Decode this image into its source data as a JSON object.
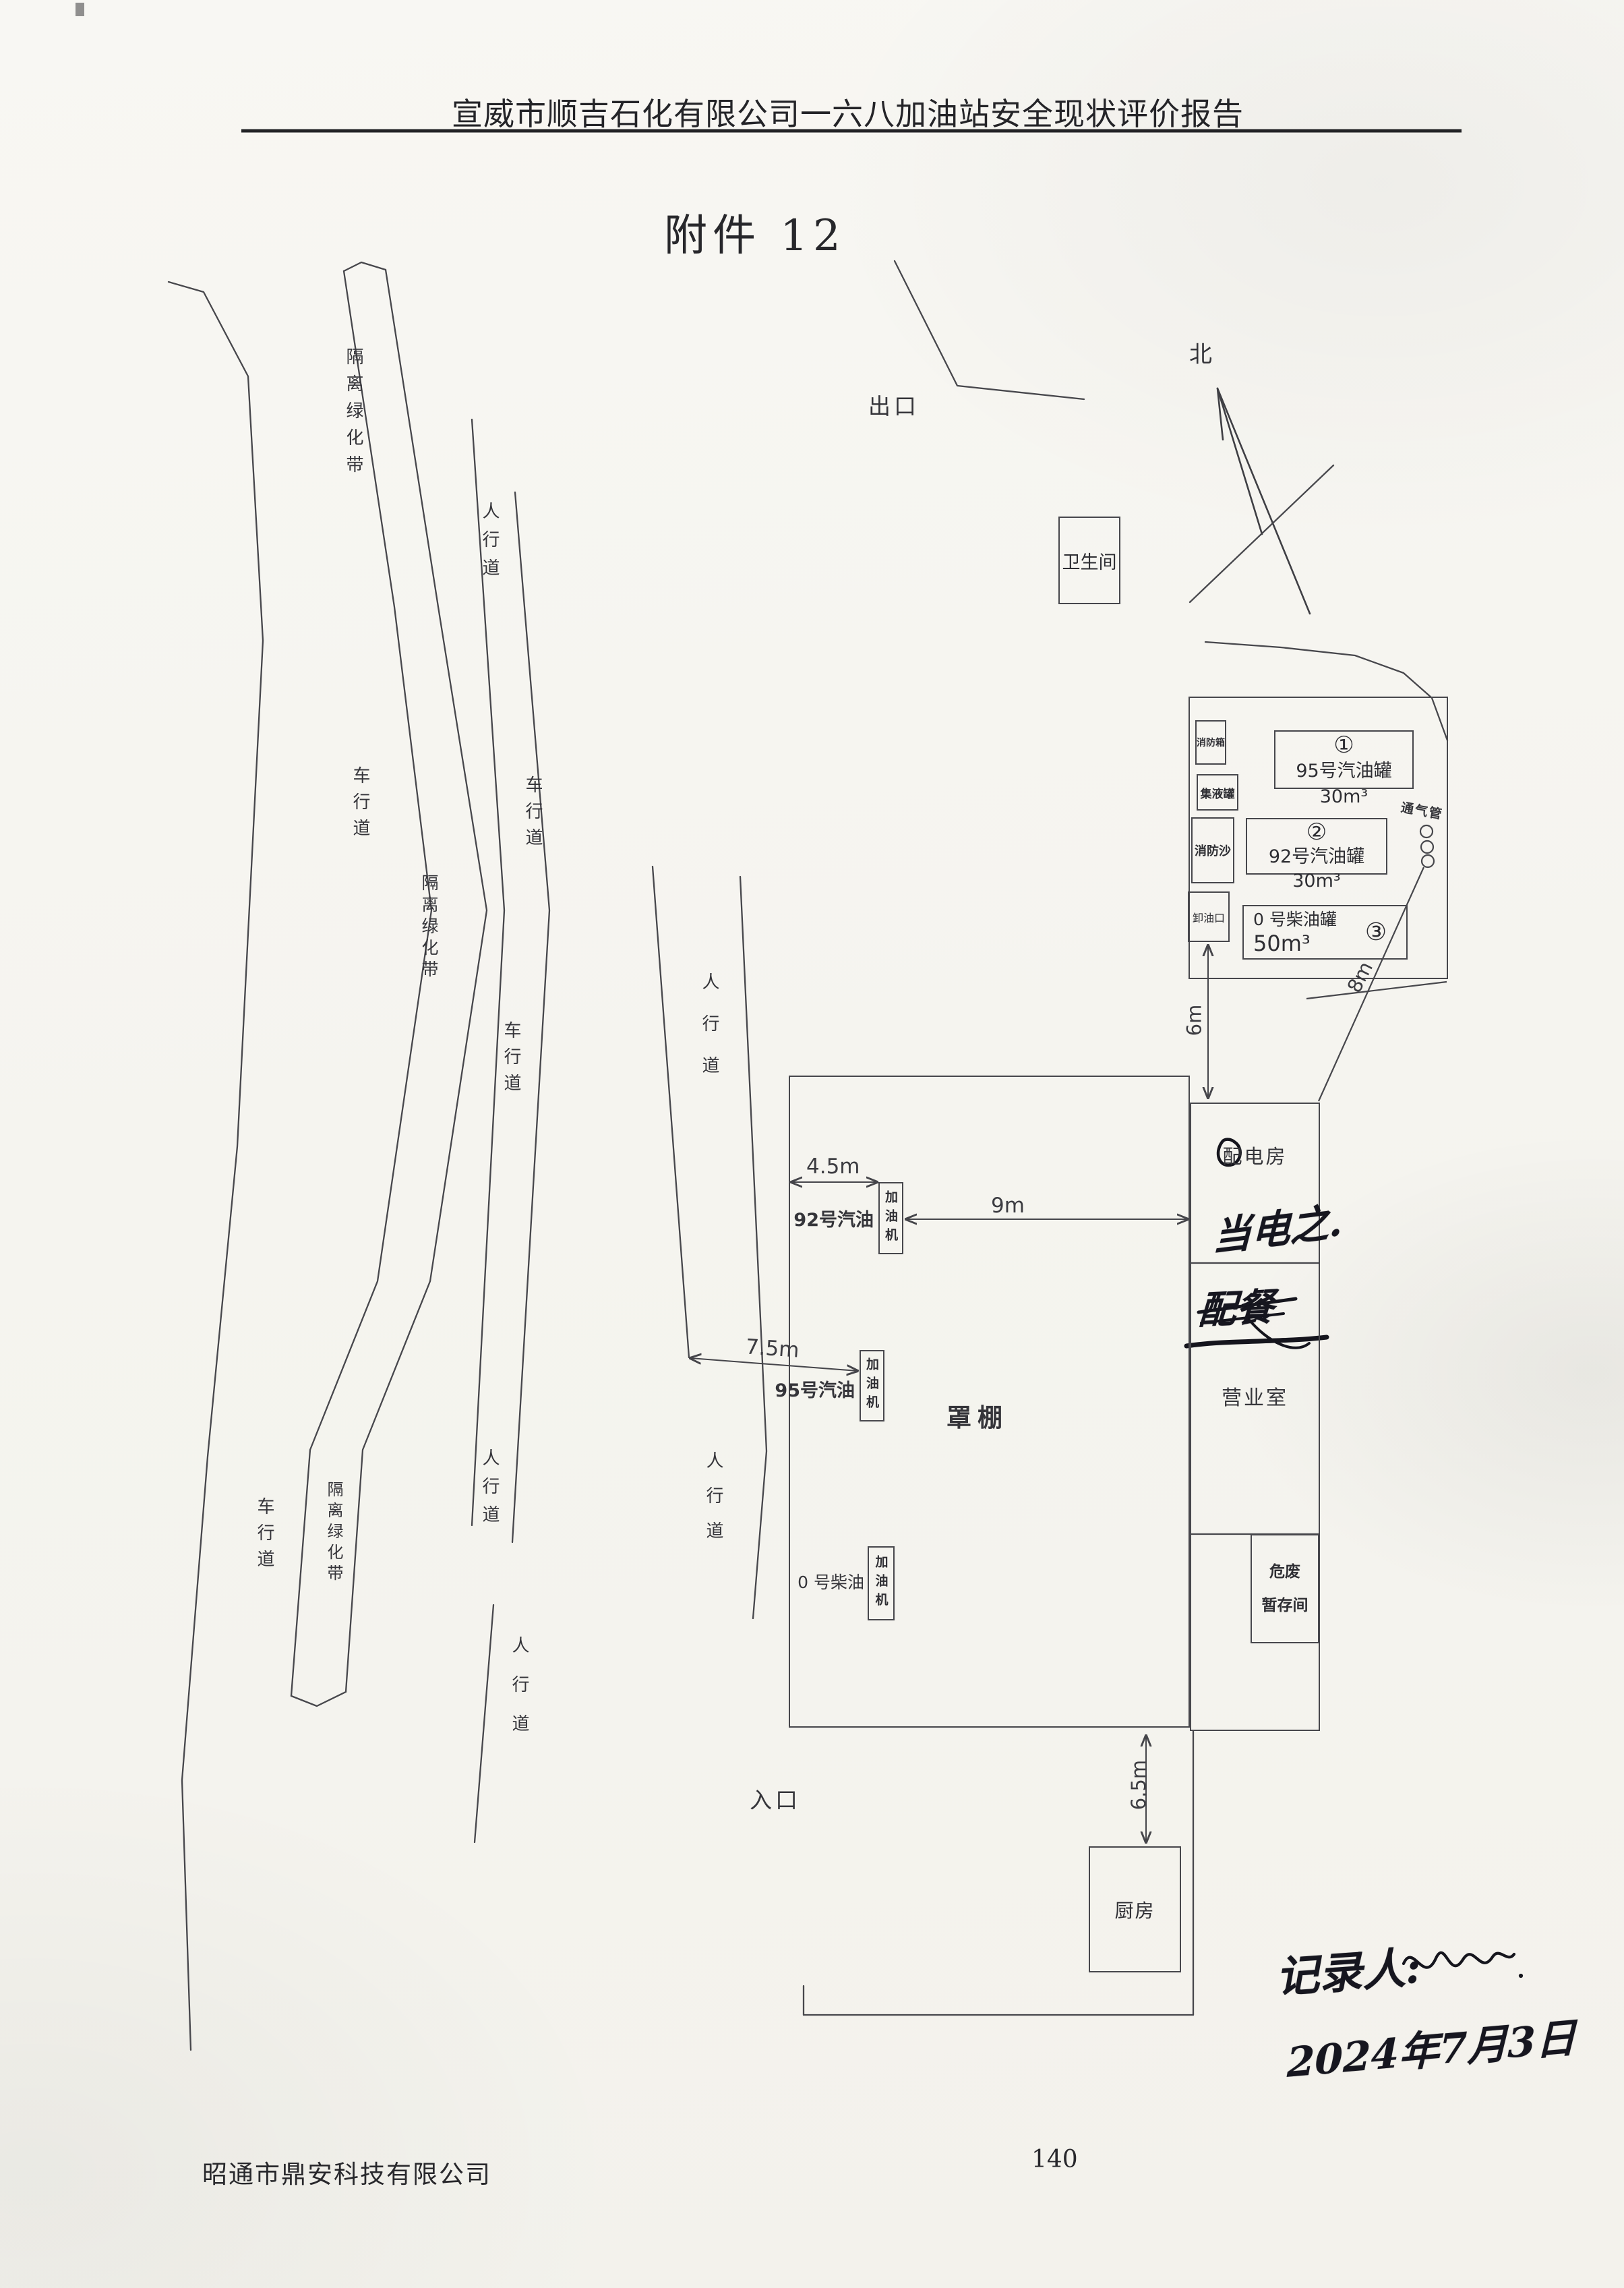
{
  "page": {
    "header_title": "宣威市顺吉石化有限公司一六八加油站安全现状评价报告",
    "attachment_title": "附件 12",
    "footer_company": "昭通市鼎安科技有限公司",
    "page_number": "140"
  },
  "compass": {
    "north": "北"
  },
  "roads": {
    "exit": "出口",
    "entrance": "入口",
    "lanes": [
      "车行道",
      "车行道",
      "车行道",
      "车行道"
    ],
    "green_belts": [
      "隔离绿化带",
      "隔离绿化带",
      "隔离绿化带"
    ],
    "sidewalks": [
      "人行道",
      "人行道",
      "人行道",
      "人行道",
      "人行道"
    ]
  },
  "facilities": {
    "restroom": "卫生间",
    "canopy": "罩棚",
    "power_room": "配电房",
    "business_room": "营业室",
    "hazwaste_line1": "危废",
    "hazwaste_line2": "暂存间",
    "kitchen": "厨房",
    "fire_cabinet": "消防箱",
    "collect_tank": "集液罐",
    "fire_sand": "消防沙",
    "unload_port": "卸油口",
    "vent_pipe": "通气管"
  },
  "tanks": [
    {
      "no": "①",
      "label": "95号汽油罐 30m³"
    },
    {
      "no": "②",
      "label": "92号汽油罐 30m³"
    },
    {
      "no": "③",
      "line1": "0 号柴油罐",
      "line2": "50m³"
    }
  ],
  "dispensers": [
    {
      "fuel": "92号汽油",
      "machine": "加油机"
    },
    {
      "fuel": "95号汽油",
      "machine": "加油机"
    },
    {
      "fuel": "0 号柴油",
      "machine": "加油机"
    }
  ],
  "dimensions": {
    "canopy_to_pump": "4.5m",
    "pump_to_building": "9m",
    "sidewalk_to_pump": "7.5m",
    "unload_to_building": "6m",
    "vent_to_corner": "8m",
    "building_to_kitchen": "6.5m"
  },
  "handwriting": {
    "note1": "当电之.",
    "note2": "配餐",
    "recorder_label": "记录人:",
    "date": "2024年7月3日"
  }
}
